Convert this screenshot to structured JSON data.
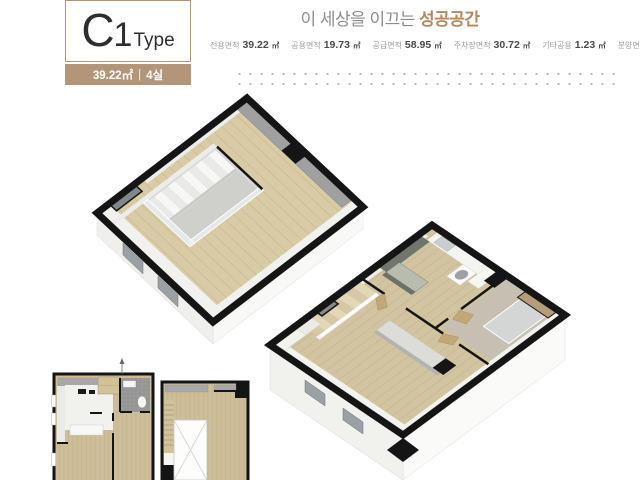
{
  "badge": {
    "letter": "C",
    "number": "1",
    "word": "Type",
    "area": "39.22㎡",
    "separator": "|",
    "rooms": "4실"
  },
  "slogan": {
    "prefix": "이 세상을 이끄는",
    "highlight": "성공공간"
  },
  "specs": {
    "items": [
      {
        "label": "전용면적",
        "value": "39.22",
        "unit": "㎡"
      },
      {
        "label": "공용면적",
        "value": "19.73",
        "unit": "㎡"
      },
      {
        "label": "공급면적",
        "value": "58.95",
        "unit": "㎡"
      },
      {
        "label": "주차장면적",
        "value": "30.72",
        "unit": "㎡"
      },
      {
        "label": "기타공용",
        "value": "1.23",
        "unit": "㎡"
      },
      {
        "label": "분양면적",
        "value": "90.91",
        "unit": "㎡"
      }
    ]
  },
  "colors": {
    "accent_tan": "#b39579",
    "highlight_brown": "#b5875f",
    "wood": "#d5c7a3",
    "wall_black": "#151515"
  }
}
